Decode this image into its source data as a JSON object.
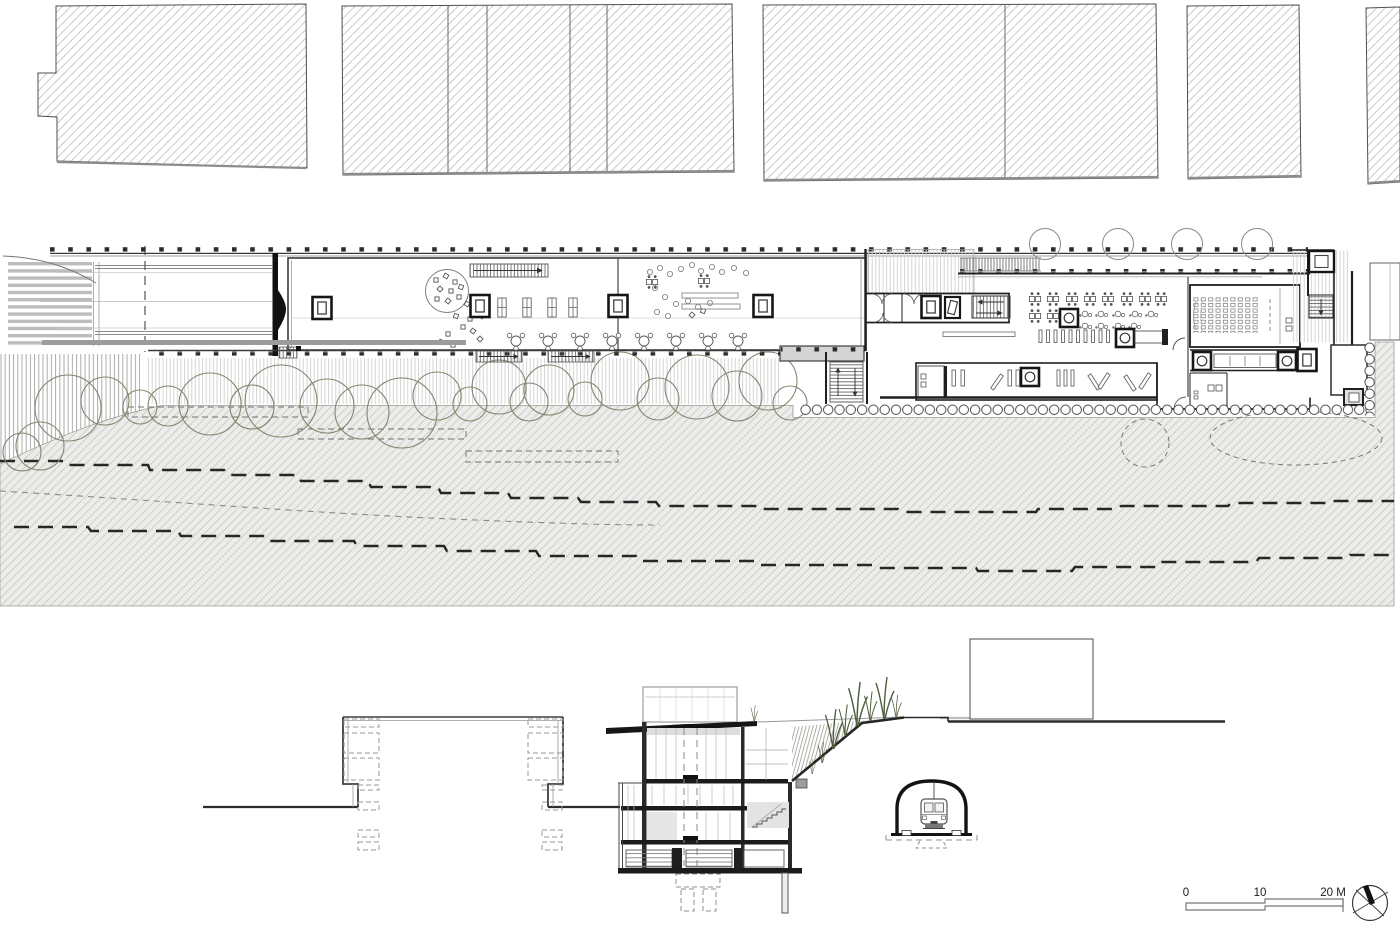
{
  "sheet": {
    "kind": "architectural-site-plan-and-section",
    "scale_bar": {
      "tick_0": "0",
      "tick_10": "10",
      "tick_20": "20 M",
      "unit": "M"
    },
    "icons": {
      "compass": "north-arrow-icon"
    },
    "colors": {
      "paper": "#ffffff",
      "ink": "#2b2b2b",
      "wall_black": "#1f1f1f",
      "light_line": "#9a9a9a",
      "block_hatch": "#b2b2b2",
      "ground_fill": "#ececea",
      "ground_hatch_line": "#c8c8c2",
      "gray_fill": "#9c9c9c",
      "tree_stroke": "#85856f",
      "grass_green": "#4f5f3d"
    }
  }
}
